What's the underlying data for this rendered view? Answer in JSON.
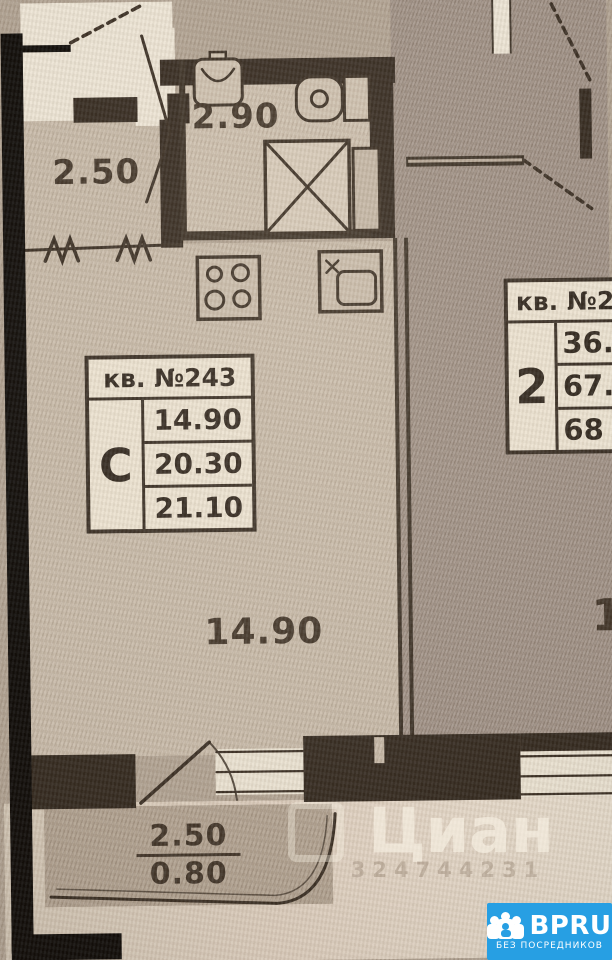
{
  "document": {
    "kind": "apartment floor plan photo"
  },
  "colors": {
    "paper": "#b2a494",
    "interior": "#c8bbaa",
    "neighbor_floor": "#a3958a",
    "walls": "#33291f",
    "badge_blue": "#279fe3",
    "card_bg": "#ebe2d1"
  },
  "plan": {
    "rooms": {
      "loggia_top": {
        "area": "2.50"
      },
      "bathroom": {
        "area": "2.90"
      },
      "living_room": {
        "area": "14.90"
      },
      "balcony_bottom": {
        "upper": "2.50",
        "lower": "0.80"
      }
    },
    "apartment_card": {
      "title": "кв. №243",
      "type": "С",
      "areas": [
        "14.90",
        "20.30",
        "21.10"
      ]
    },
    "neighbor_card": {
      "title": "кв. №2",
      "type": "2",
      "areas": [
        "36.",
        "67.",
        "68"
      ]
    },
    "neighbor_room_partial": "1",
    "icons": [
      "wash-basin-icon",
      "toilet-icon",
      "shower-tray-icon",
      "duct-shaft-icon",
      "stove-icon",
      "kitchen-sink-icon",
      "door-swing-icon",
      "balcony-rail-break-icon"
    ]
  },
  "watermark": {
    "brand": "Циан",
    "digits": "324744231"
  },
  "badge": {
    "brand": "BPRU",
    "tagline": "БЕЗ ПОСРЕДНИКОВ"
  }
}
